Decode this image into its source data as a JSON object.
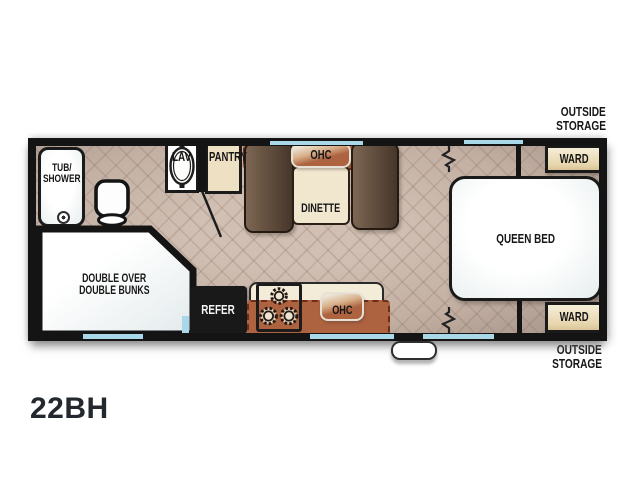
{
  "model_code": "22BH",
  "exterior": {
    "storage_front": {
      "line1": "OUTSIDE",
      "line2": "STORAGE"
    },
    "storage_rear": {
      "line1": "OUTSIDE",
      "line2": "STORAGE"
    }
  },
  "bathroom": {
    "tub_label_line1": "TUB/",
    "tub_label_line2": "SHOWER",
    "lav_label": "LAV"
  },
  "kitchen": {
    "pantry_label": "PANTRY",
    "refer_label": "REFER",
    "ohc_label": "OHC"
  },
  "dinette": {
    "ohc_label": "OHC",
    "table_label": "DINETTE"
  },
  "bunk_room": {
    "label_line1": "DOUBLE OVER",
    "label_line2": "DOUBLE BUNKS"
  },
  "bedroom": {
    "bed_label": "QUEEN BED",
    "ward_front_label": "WARD",
    "ward_rear_label": "WARD"
  },
  "colors": {
    "wall": "#141414",
    "floor_tile": "#c6b3a6",
    "window_glass": "#a9d8e8",
    "cabinet_rust": "#ad6240",
    "wood_tan": "#ecdfc0",
    "bench_brown": "#5d4a3b",
    "refer_black": "#191919",
    "text": "#161616"
  }
}
